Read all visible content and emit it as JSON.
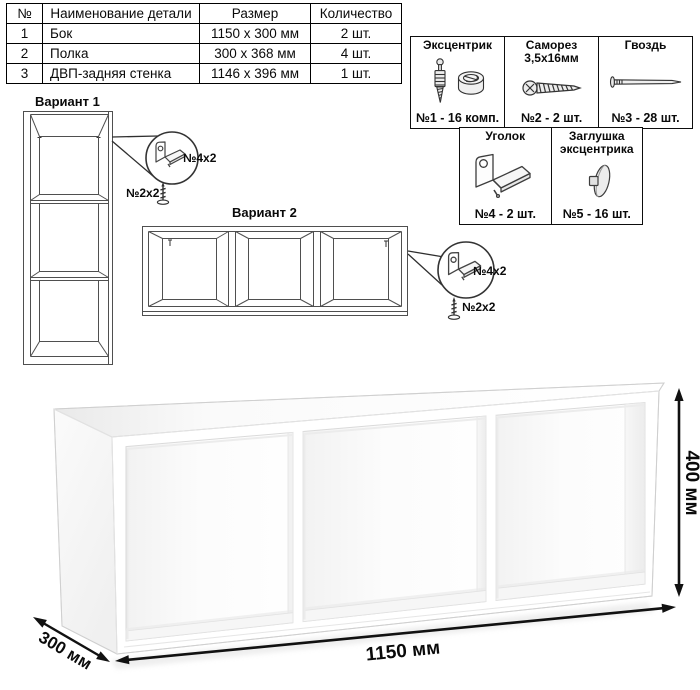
{
  "parts_table": {
    "headers": [
      "№",
      "Наименование детали",
      "Размер",
      "Количество"
    ],
    "rows": [
      {
        "num": "1",
        "name": "Бок",
        "size": "1150 x 300 мм",
        "qty": "2 шт."
      },
      {
        "num": "2",
        "name": "Полка",
        "size": "300 x 368 мм",
        "qty": "4 шт."
      },
      {
        "num": "3",
        "name": "ДВП-задняя стенка",
        "size": "1146 x 396 мм",
        "qty": "1 шт."
      }
    ]
  },
  "hardware": {
    "cells": [
      {
        "title": "Эксцентрик",
        "subtitle": "",
        "count": "№1 - 16 комп."
      },
      {
        "title": "Саморез",
        "subtitle": "3,5х16мм",
        "count": "№2 - 2 шт."
      },
      {
        "title": "Гвоздь",
        "subtitle": "",
        "count": "№3 - 28 шт."
      },
      {
        "title": "Уголок",
        "subtitle": "",
        "count": "№4 - 2 шт."
      },
      {
        "title": "Заглушка",
        "subtitle": "эксцентрика",
        "count": "№5 - 16 шт."
      }
    ]
  },
  "variants": {
    "v1": {
      "title": "Вариант 1",
      "bracket_label": "№4х2",
      "screw_label": "№2х2"
    },
    "v2": {
      "title": "Вариант 2",
      "bracket_label": "№4х2",
      "screw_label": "№2х2"
    }
  },
  "dimensions": {
    "width": "1150 мм",
    "height": "400 мм",
    "depth": "300 мм"
  }
}
